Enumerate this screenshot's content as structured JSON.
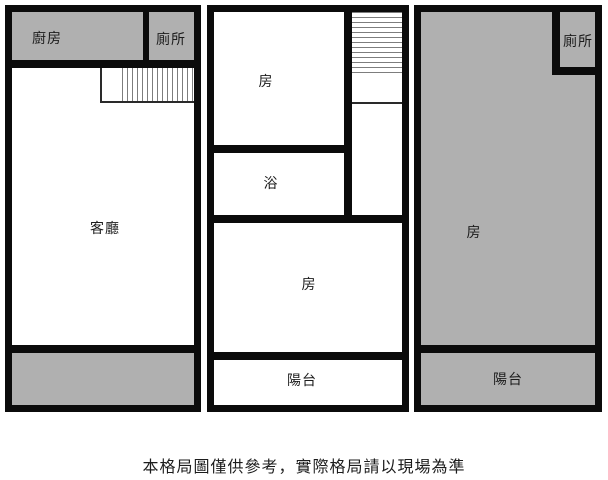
{
  "colors": {
    "wall": "#0b0b0b",
    "room_gray_fill": "#b0b0b0",
    "room_white_fill": "#ffffff",
    "stair_hatch_line": "#7d7d7d",
    "label_text": "#1c1c1c"
  },
  "floor_plans": {
    "left": {
      "kitchen": "廚房",
      "toilet": "廁所",
      "living_room": "客廳"
    },
    "middle": {
      "room_top": "房",
      "bath": "浴",
      "room_bottom": "房",
      "balcony": "陽台"
    },
    "right": {
      "toilet": "廁所",
      "room": "房",
      "balcony": "陽台"
    }
  },
  "disclaimer": "本格局圖僅供參考，實際格局請以現場為準"
}
